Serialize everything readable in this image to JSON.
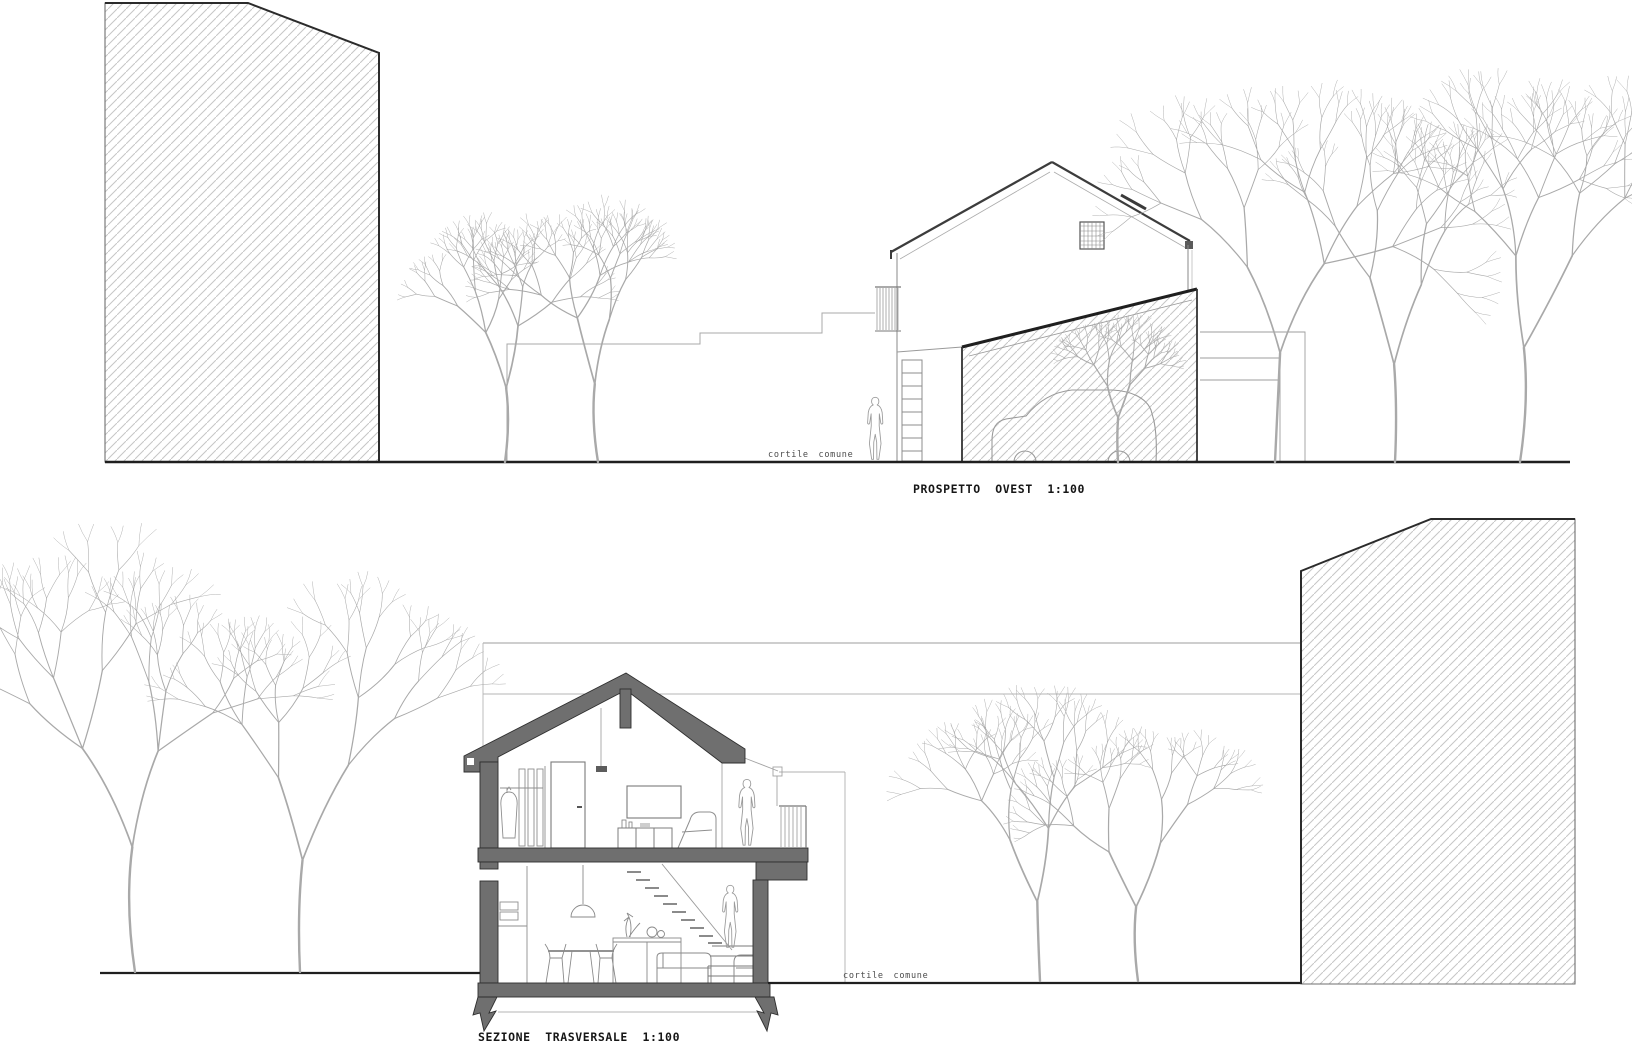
{
  "drawings": {
    "west_elevation": {
      "title": "PROSPETTO OVEST 1:100",
      "courtyard_label": "cortile comune"
    },
    "cross_section": {
      "title": "SEZIONE TRASVERSALE 1:100",
      "courtyard_label": "cortile comune"
    }
  },
  "scale": "1:100",
  "colors": {
    "paper": "#ffffff",
    "ink": "#1c1c1c",
    "section_poche": "#6f6f6f",
    "hatch_line": "#c6c6c6",
    "light_line": "#9c9c9c",
    "tree_line": "#a9a9a9"
  }
}
